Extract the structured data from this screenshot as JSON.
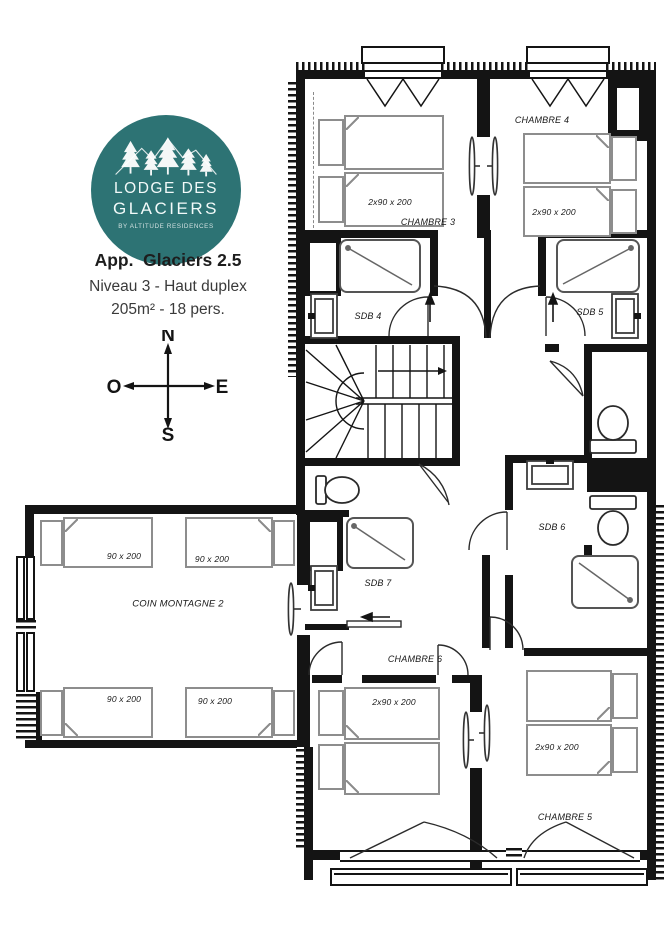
{
  "branding": {
    "logo_line1": "LODGE DES",
    "logo_line2": "GLACIERS",
    "logo_tagline": "BY ALTITUDE RESIDENCES",
    "logo_color": "#2d7374"
  },
  "apartment": {
    "title": "App.  Glaciers 2.5",
    "level": "Niveau 3 - Haut duplex",
    "capacity": "205m² - 18 pers."
  },
  "compass": {
    "north": "N",
    "south": "S",
    "east": "E",
    "west": "O"
  },
  "plan": {
    "rooms": {
      "chambre3": {
        "label": "CHAMBRE 3",
        "beds": "2x90 x 200"
      },
      "chambre4": {
        "label": "CHAMBRE 4",
        "beds": "2x90 x 200"
      },
      "chambre5": {
        "label": "CHAMBRE 5",
        "beds": "2x90 x 200"
      },
      "chambre6": {
        "label": "CHAMBRE 6",
        "beds": "2x90 x 200"
      },
      "sdb4": {
        "label": "SDB 4"
      },
      "sdb5": {
        "label": "SDB 5"
      },
      "sdb6": {
        "label": "SDB 6"
      },
      "sdb7": {
        "label": "SDB 7"
      },
      "coin_montagne": {
        "label": "COIN MONTAGNE 2",
        "bed1": "90 x 200",
        "bed2": "90 x 200",
        "bed3": "90 x 200",
        "bed4": "90 x 200"
      }
    }
  }
}
